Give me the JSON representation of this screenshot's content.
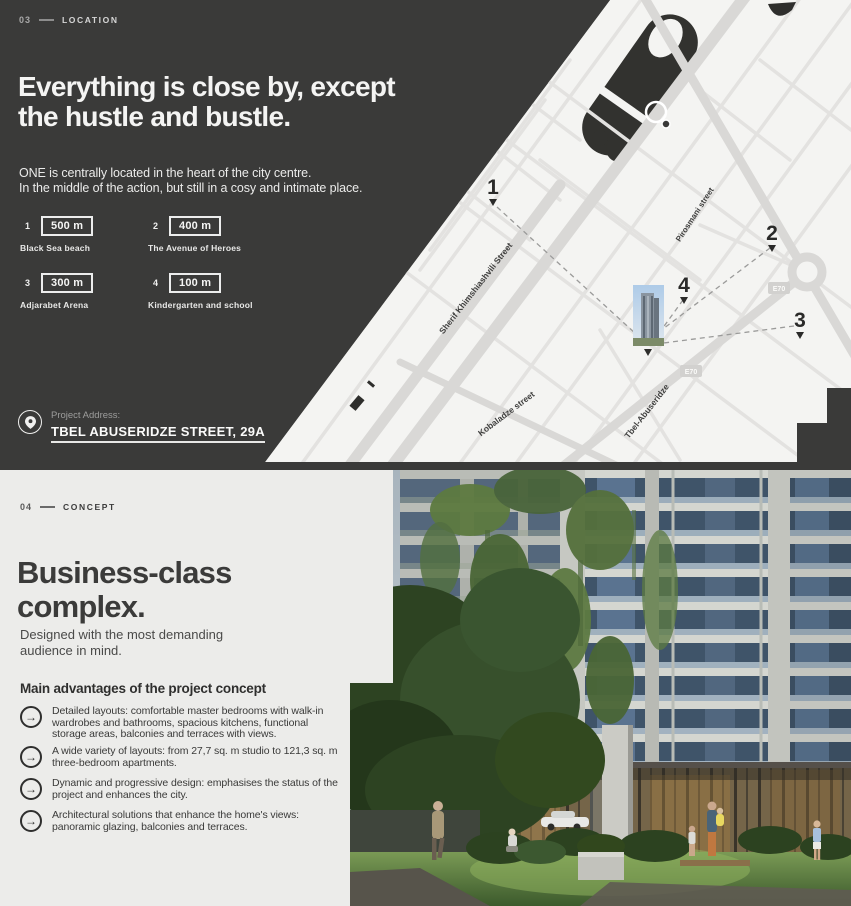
{
  "location": {
    "index": "03",
    "label": "LOCATION",
    "heading_line1": "Everything is close by, except",
    "heading_line2": "the hustle and bustle.",
    "subtext_line1": "ONE is centrally located in the heart of the city centre.",
    "subtext_line2": "In the middle of the action, but still in a cosy and intimate place.",
    "distances": [
      {
        "num": "1",
        "distance": "500 m",
        "label": "Black Sea beach"
      },
      {
        "num": "2",
        "distance": "400 m",
        "label": "The Avenue of Heroes"
      },
      {
        "num": "3",
        "distance": "300 m",
        "label": "Adjarabet Arena"
      },
      {
        "num": "4",
        "distance": "100 m",
        "label": "Kindergarten and school"
      }
    ],
    "address_label": "Project Address:",
    "address_value": "TBEL ABUSERIDZE STREET, 29A"
  },
  "map": {
    "labels": {
      "sherif": "Sherif Khimshiashvili Street",
      "pirosmani": "Pirosmani street",
      "kobaladze": "Kobaladze street",
      "tbel": "Tbel-Abuseridze"
    },
    "badge": "E70",
    "markers": [
      "1",
      "2",
      "3",
      "4"
    ]
  },
  "concept": {
    "index": "04",
    "label": "CONCEPT",
    "heading_line1": "Business-class",
    "heading_line2": "complex.",
    "subtext_line1": "Designed with the most demanding",
    "subtext_line2": "audience in mind.",
    "advantages_title": "Main advantages of the project concept",
    "advantages": [
      {
        "text": "Detailed layouts: comfortable master bedrooms with walk-in wardrobes and bathrooms, spacious kitchens, functional storage areas, balconies and terraces with views."
      },
      {
        "text": "A wide variety of layouts: from 27,7 sq. m studio to 121,3 sq. m three-bedroom apartments."
      },
      {
        "text": "Dynamic and progressive design: emphasises the status of the project and enhances the city."
      },
      {
        "text": "Architectural solutions that enhance the home's views: panoramic glazing, balconies and terraces."
      }
    ]
  },
  "colors": {
    "dark_bg": "#3a3a39",
    "light_bg": "#ececea",
    "map_bg": "#f4f4f2",
    "text_light": "#f4f4f3",
    "text_dark": "#3b3b3a"
  }
}
